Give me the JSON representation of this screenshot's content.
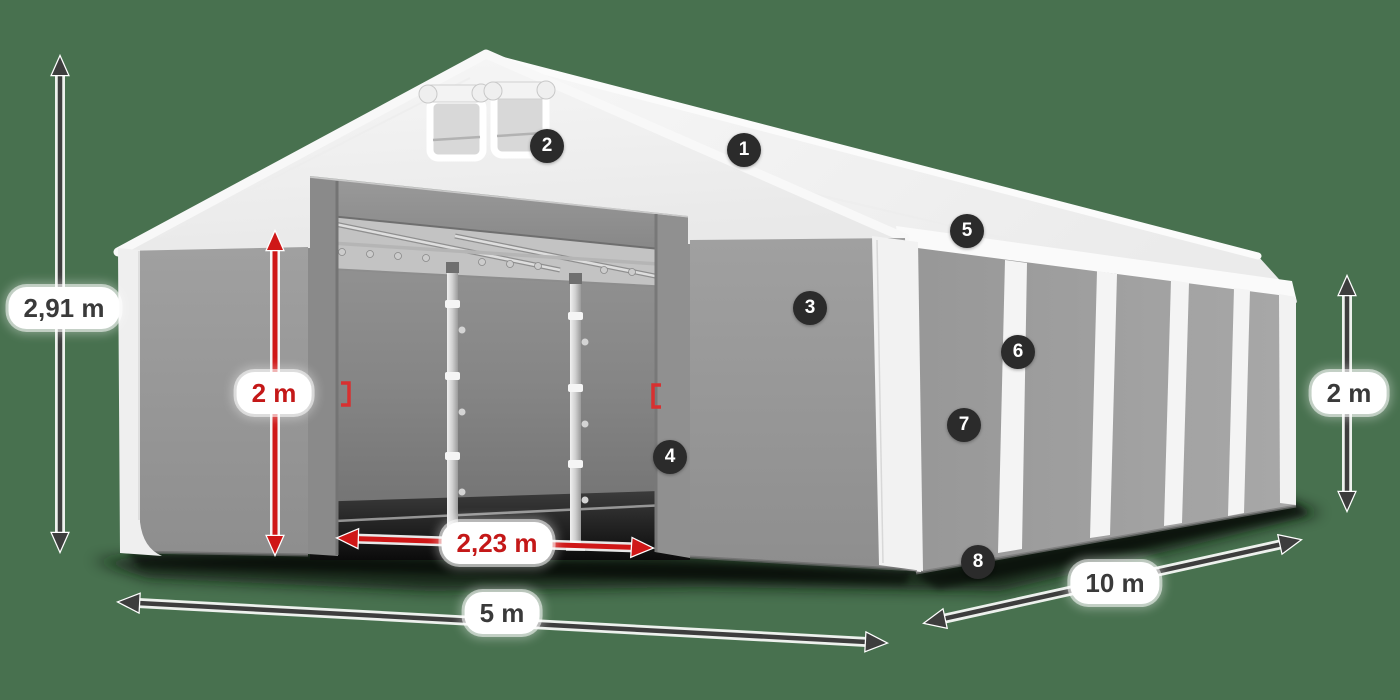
{
  "scene": {
    "background_color": "#48714f"
  },
  "colors": {
    "dimension_arrow_dark": "#3d3d3d",
    "dimension_accent_red": "#cf1717",
    "badge_background": "#2b2b2b",
    "badge_text": "#ffffff",
    "roof_white": "#f2f2f2",
    "wall_gray": "#9b9b9b"
  },
  "dimensions": {
    "total_height": "2,91 m",
    "wall_height_inner": "2 m",
    "wall_height_side": "2 m",
    "door_width": "2,23 m",
    "tent_width": "5 m",
    "tent_length": "10 m"
  },
  "hotspots": [
    {
      "number": "1"
    },
    {
      "number": "2"
    },
    {
      "number": "3"
    },
    {
      "number": "4"
    },
    {
      "number": "5"
    },
    {
      "number": "6"
    },
    {
      "number": "7"
    },
    {
      "number": "8"
    }
  ]
}
